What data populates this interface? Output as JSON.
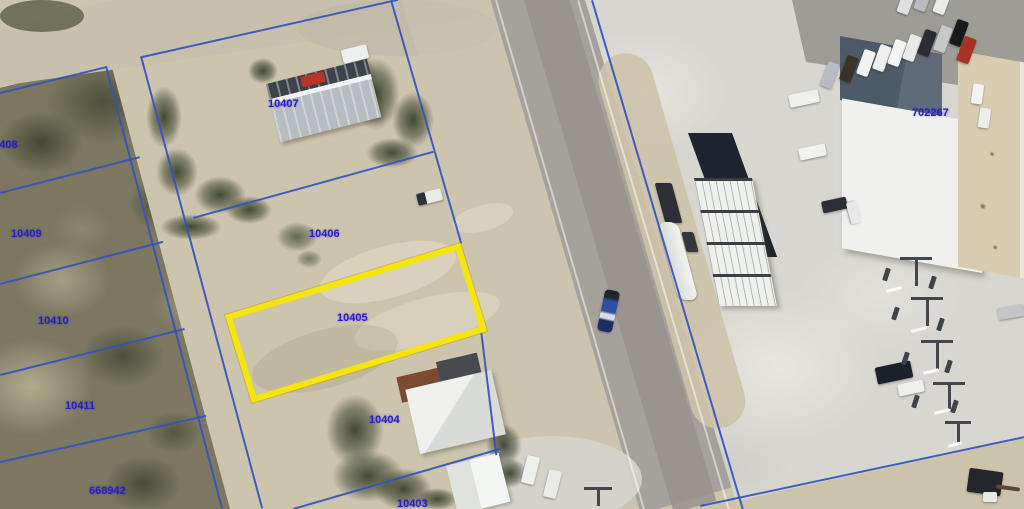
{
  "map": {
    "title": "Aerial parcel map with highlighted lot",
    "highlighted_parcel_id": "10405",
    "colors": {
      "parcel_line": "#3453bd",
      "highlight": "#f5e509",
      "label": "#2620cf"
    },
    "parcel_labels": [
      {
        "id": "10408"
      },
      {
        "id": "10409"
      },
      {
        "id": "10410"
      },
      {
        "id": "10411"
      },
      {
        "id": "668942"
      },
      {
        "id": "10407"
      },
      {
        "id": "10406"
      },
      {
        "id": "10405"
      },
      {
        "id": "10404"
      },
      {
        "id": "10403"
      },
      {
        "id": "702267"
      }
    ]
  }
}
